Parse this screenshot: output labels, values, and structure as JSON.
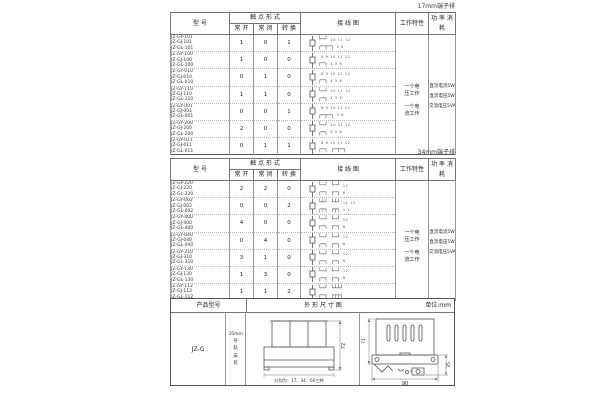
{
  "headers": {
    "model": "型 号",
    "contact_form": "触 点 形 式",
    "no": "常 开",
    "nc": "常 闭",
    "co": "转 换",
    "wiring": "接 线 图",
    "work": "工作特性",
    "power": "功 率 消 耗"
  },
  "work_labels": [
    "一个电\n压工作",
    "一个电\n流工作"
  ],
  "power_labels": [
    "直流电流5W",
    "直流电压5W",
    "交流电压5VA"
  ],
  "tables": [
    {
      "corner_label": "17mm端子排",
      "rows": [
        {
          "models": [
            "JZ-GY-101",
            "JZ-GJ-101",
            "JZ-GL-101"
          ],
          "normally_open": "1",
          "normally_closed": "0",
          "changeover": "1",
          "diagram": {
            "top_glyph": "└─┘",
            "top_nums": "10 11 12",
            "bottom_glyph": "┌─┬─┐",
            "bottom_nums": "5  6"
          }
        },
        {
          "models": [
            "JZ-GY-100",
            "JZ-GJ-100",
            "JZ-GL-100"
          ],
          "normally_open": "1",
          "normally_closed": "0",
          "changeover": "0",
          "diagram": {
            "top_glyph": "",
            "top_nums": "8  9  10 11 12",
            "bottom_glyph": "┌─┐",
            "bottom_nums": "4  5  6"
          }
        },
        {
          "models": [
            "JZ-GY-010",
            "JZ-GJ-010",
            "JZ-GL-010"
          ],
          "normally_open": "0",
          "normally_closed": "1",
          "changeover": "0",
          "diagram": {
            "top_glyph": "",
            "top_nums": "8  9  10 11 12",
            "bottom_glyph": "┌─┐",
            "bottom_nums": "4  5  6"
          }
        },
        {
          "models": [
            "JZ-GY-110",
            "JZ-GJ-110",
            "JZ-GL-110"
          ],
          "normally_open": "1",
          "normally_closed": "1",
          "changeover": "0",
          "diagram": {
            "top_glyph": "└─┘",
            "top_nums": "10 11 12",
            "bottom_glyph": "┌─┐",
            "bottom_nums": "4  5  6"
          }
        },
        {
          "models": [
            "JZ-GY-001",
            "JZ-GJ-001",
            "JZ-GL-001"
          ],
          "normally_open": "0",
          "normally_closed": "0",
          "changeover": "1",
          "diagram": {
            "top_glyph": "",
            "top_nums": "8  9  10 11 12",
            "bottom_glyph": "┌─┬─┐",
            "bottom_nums": "5  6"
          }
        },
        {
          "models": [
            "JZ-GY-200",
            "JZ-GJ-200",
            "JZ-GL-200"
          ],
          "normally_open": "2",
          "normally_closed": "0",
          "changeover": "0",
          "diagram": {
            "top_glyph": "└─┘",
            "top_nums": "10 11 12",
            "bottom_glyph": "┌─┐",
            "bottom_nums": "4  5  6"
          }
        },
        {
          "models": [
            "JZ-GY-011",
            "JZ-GJ-011",
            "JZ-GL-011"
          ],
          "normally_open": "0",
          "normally_closed": "1",
          "changeover": "1",
          "diagram": {
            "top_glyph": "",
            "top_nums": "8  9  10 11 12",
            "bottom_glyph": "┌─┐ ┌─┬─┐",
            "bottom_nums": ""
          }
        }
      ]
    },
    {
      "corner_label": "34mm端子排",
      "rows": [
        {
          "models": [
            "JZ-GY-220",
            "JZ-GJ-220",
            "JZ-GL-220"
          ],
          "normally_open": "2",
          "normally_closed": "2",
          "changeover": "0",
          "diagram": {
            "top_glyph": "└─┘ └─┘",
            "top_nums": "12",
            "bottom_glyph": "┌─┐ ┌─┐",
            "bottom_nums": "6"
          }
        },
        {
          "models": [
            "JZ-GY-002",
            "JZ-GJ-002",
            "JZ-GL-002"
          ],
          "normally_open": "0",
          "normally_closed": "0",
          "changeover": "2",
          "diagram": {
            "top_glyph": "└┴┘ └┴┘",
            "top_nums": "11 12",
            "bottom_glyph": "┌┬┐ ┌┬┐",
            "bottom_nums": "1  4"
          }
        },
        {
          "models": [
            "JZ-GY-400",
            "JZ-GJ-400",
            "JZ-GL-400"
          ],
          "normally_open": "4",
          "normally_closed": "0",
          "changeover": "0",
          "diagram": {
            "top_glyph": "└─┘ └─┘",
            "top_nums": "12",
            "bottom_glyph": "┌─┐ ┌─┐",
            "bottom_nums": "6"
          }
        },
        {
          "models": [
            "JZ-GY-040",
            "JZ-GJ-040",
            "JZ-GL-040"
          ],
          "normally_open": "0",
          "normally_closed": "4",
          "changeover": "0",
          "diagram": {
            "top_glyph": "└─┘ └─┘",
            "top_nums": "12",
            "bottom_glyph": "┌─┐ ┌─┐",
            "bottom_nums": "6"
          }
        },
        {
          "models": [
            "JZ-GY-310",
            "JZ-GJ-310",
            "JZ-GL-310"
          ],
          "normally_open": "3",
          "normally_closed": "1",
          "changeover": "0",
          "diagram": {
            "top_glyph": "└─┘ └─┘",
            "top_nums": "12",
            "bottom_glyph": "┌─┐ ┌─┐",
            "bottom_nums": "6"
          }
        },
        {
          "models": [
            "JZ-GY-130",
            "JZ-GJ-130",
            "JZ-GL-130"
          ],
          "normally_open": "1",
          "normally_closed": "3",
          "changeover": "0",
          "diagram": {
            "top_glyph": "└─┘ └─┘",
            "top_nums": "12",
            "bottom_glyph": "┌─┐ ┌─┐",
            "bottom_nums": "6"
          }
        },
        {
          "models": [
            "JZ-GY-112",
            "JZ-GJ-112",
            "JZ-GL-112"
          ],
          "normally_open": "1",
          "normally_closed": "1",
          "changeover": "2",
          "diagram": {
            "top_glyph": "└─┘ └┴┴┘",
            "top_nums": "",
            "bottom_glyph": "┌─┐ ┌┬┬┐",
            "bottom_nums": ""
          }
        }
      ]
    }
  ],
  "dimension_table": {
    "header_product": "产品型号",
    "header_outline": "外 形 尺 寸 图",
    "header_unit": "单位:mm",
    "product_model": "JZ-G",
    "mounting_lines": [
      "35mm",
      "导",
      "轨",
      "安",
      "装"
    ],
    "front_caption": "分别为：17、34、60三种",
    "front_height": "72",
    "side_height": "71",
    "side_rail": "35",
    "side_depth": "90"
  }
}
